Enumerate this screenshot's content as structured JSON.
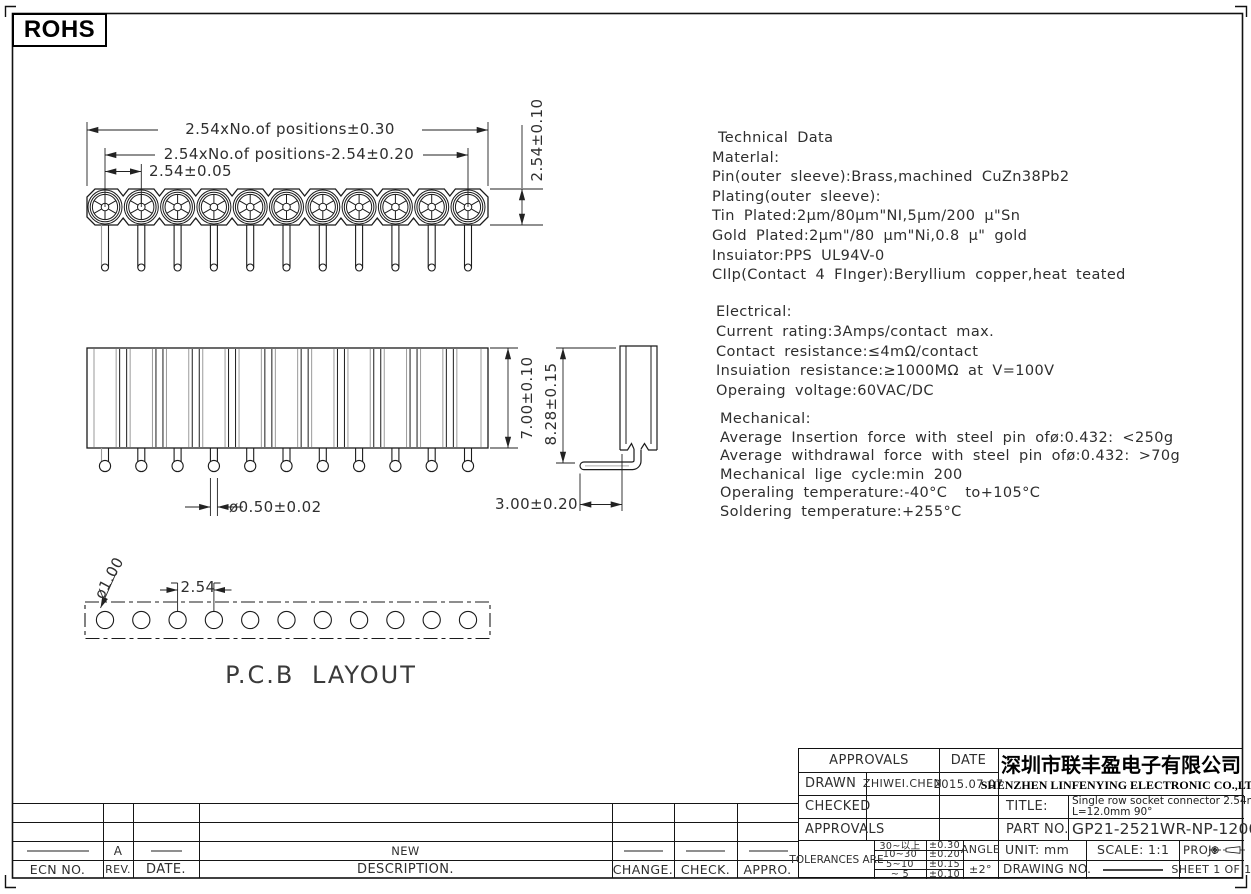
{
  "page": {
    "rohs_label": "ROHS"
  },
  "tech": {
    "material": [
      "Technical Data",
      "Materlal:",
      "Pin(outer sleeve):Brass,machined CuZn38Pb2",
      "Plating(outer sleeve):",
      "Tin Plated:2μm/80μm\"NI,5μm/200 μ\"Sn",
      "Gold Plated:2μm\"/80 μm\"Ni,0.8 μ\" gold",
      "Insuiator:PPS UL94V-0",
      "CIlp(Contact 4 FInger):Beryllium copper,heat teated"
    ],
    "electrical": [
      "Electrical:",
      "Current rating:3Amps/contact max.",
      "Contact resistance:≤4mΩ/contact",
      "Insuiation resistance:≥1000MΩ at V=100V",
      "Operaing voltage:60VAC/DC"
    ],
    "mechanical": [
      "Mechanical:",
      "Average Insertion force with steel pin ofø:0.432: <250g",
      "Average withdrawal force with steel pin ofø:0.432: >70g",
      "Mechanical lige cycle:min 200",
      "Operaling temperature:-40°C  to+105°C",
      "Soldering temperature:+255°C"
    ]
  },
  "drawing": {
    "positions": 11,
    "pcb_label": "P.C.B LAYOUT",
    "dims": {
      "overall": "2.54xNo.of positions±0.30",
      "centers": "2.54xNo.of positions-2.54±0.20",
      "pitch": "2.54±0.05",
      "body_depth": "2.54±0.10",
      "body_height": "7.00±0.10",
      "pin_dia": "ø0.50±0.02",
      "total_height": "8.28±0.15",
      "pin_length": "3.00±0.20",
      "pcb_pitch": "2.54",
      "hole_dia": "ø1.00"
    }
  },
  "revision_table": {
    "headers": [
      "ECN NO.",
      "REV.",
      "DATE.",
      "DESCRIPTION.",
      "CHANGE.",
      "CHECK.",
      "APPRO."
    ],
    "row": {
      "rev": "A",
      "description": "NEW"
    }
  },
  "title_block": {
    "approvals_header": "APPROVALS",
    "date_header": "DATE",
    "drawn_label": "DRAWN",
    "drawn_by": "ZHIWEI.CHEN",
    "drawn_date": "2015.07.07",
    "checked_label": "CHECKED",
    "approvals_row_label": "APPROVALS",
    "company_cn": "深圳市联丰盈电子有限公司",
    "company_en": "SHENZHEN LINFENYING ELECTRONIC CO.,LTD",
    "title_label": "TITLE:",
    "title_line1": "Single row socket connector 2.54mm",
    "title_line2": "L=12.0mm  90°",
    "part_no_label": "PART NO.",
    "part_no": "GP21-2521WR-NP-1200B",
    "tolerances_label": "TOLERANCES ARE",
    "tolerances": [
      [
        "30~以上",
        "±0.30"
      ],
      [
        "10~30",
        "±0.20"
      ],
      [
        "5~10",
        "±0.15"
      ],
      [
        "~ 5",
        "±0.10"
      ]
    ],
    "angle_label": "ANGLE",
    "angle_value": "±2°",
    "unit": "UNIT: mm",
    "scale": "SCALE:  1:1",
    "proj_label": "PROJ:",
    "drawing_no_label": "DRAWING NO.",
    "sheet": "SHEET  1 OF 1"
  }
}
